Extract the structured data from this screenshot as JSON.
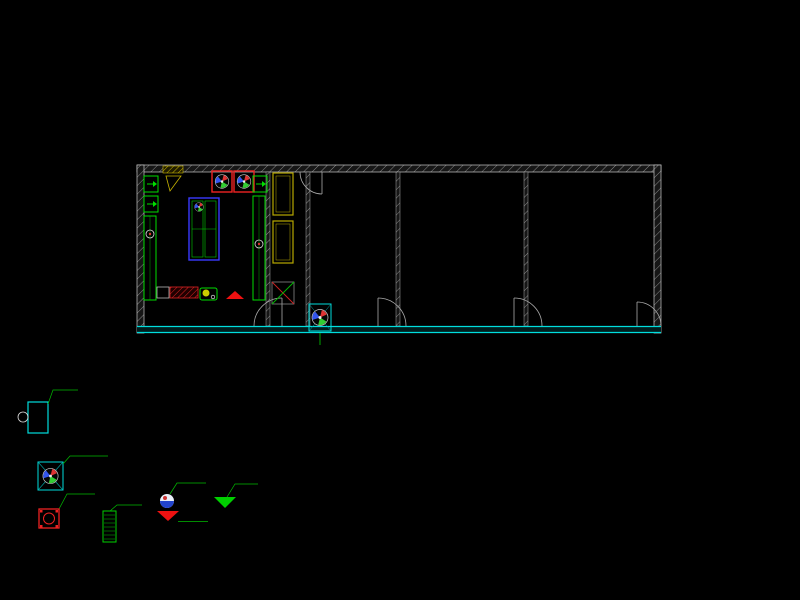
{
  "watermark": {
    "cn": "济南腾昊科学仪器有限公司",
    "en": "JINAN TENGHAO SCIENTIFIC INSTRUMENTS CO.,LTD"
  },
  "grid": {
    "axis_numbers": [
      "1",
      "2",
      "3",
      "5",
      "6",
      "7",
      "8",
      "9",
      "10"
    ],
    "side_letters": [
      "C",
      "B",
      "A"
    ],
    "segment_dim": "3200",
    "total_dim": "25600",
    "side_dims": {
      "c_to_b": "6400",
      "b_to_a": "1600",
      "total": "8000"
    }
  },
  "plan": {
    "room1_label": "理化实验室",
    "central_bench_text": "中央实验台",
    "clean_bench_text": "超净工作台",
    "middle_room_label": "18㎡",
    "ws_label": "WS",
    "storage1_label": "库房 1",
    "storage2_label": "库房 2",
    "door_left": "M-1521",
    "door_right": "M-1021",
    "entry_fan_label": "XAJ",
    "entry_dim": "50",
    "red_spec": "2400×750×850"
  },
  "legend": {
    "incubator": {
      "power": "1000W",
      "text": "恒温培养箱"
    },
    "fan_unit": {
      "volt": "380V",
      "power": "1.5KW"
    },
    "red_box": {
      "power": "4.5KW"
    },
    "green_box": {
      "power": "5.0KW"
    },
    "power_socket": {
      "label": "电源插座"
    },
    "socket_10a": {
      "label": "10A 插座"
    },
    "socket_16a": {
      "label": "16A 插座"
    }
  },
  "colors": {
    "background": "#000000",
    "grid_green": "#00c000",
    "wall_gray": "#9a9a9a",
    "cyan": "#00dddd",
    "bench_green": "#00dd00",
    "accent_red": "#ee2222",
    "accent_yellow": "#c8b400",
    "dim_text": "#e8e8e8"
  }
}
